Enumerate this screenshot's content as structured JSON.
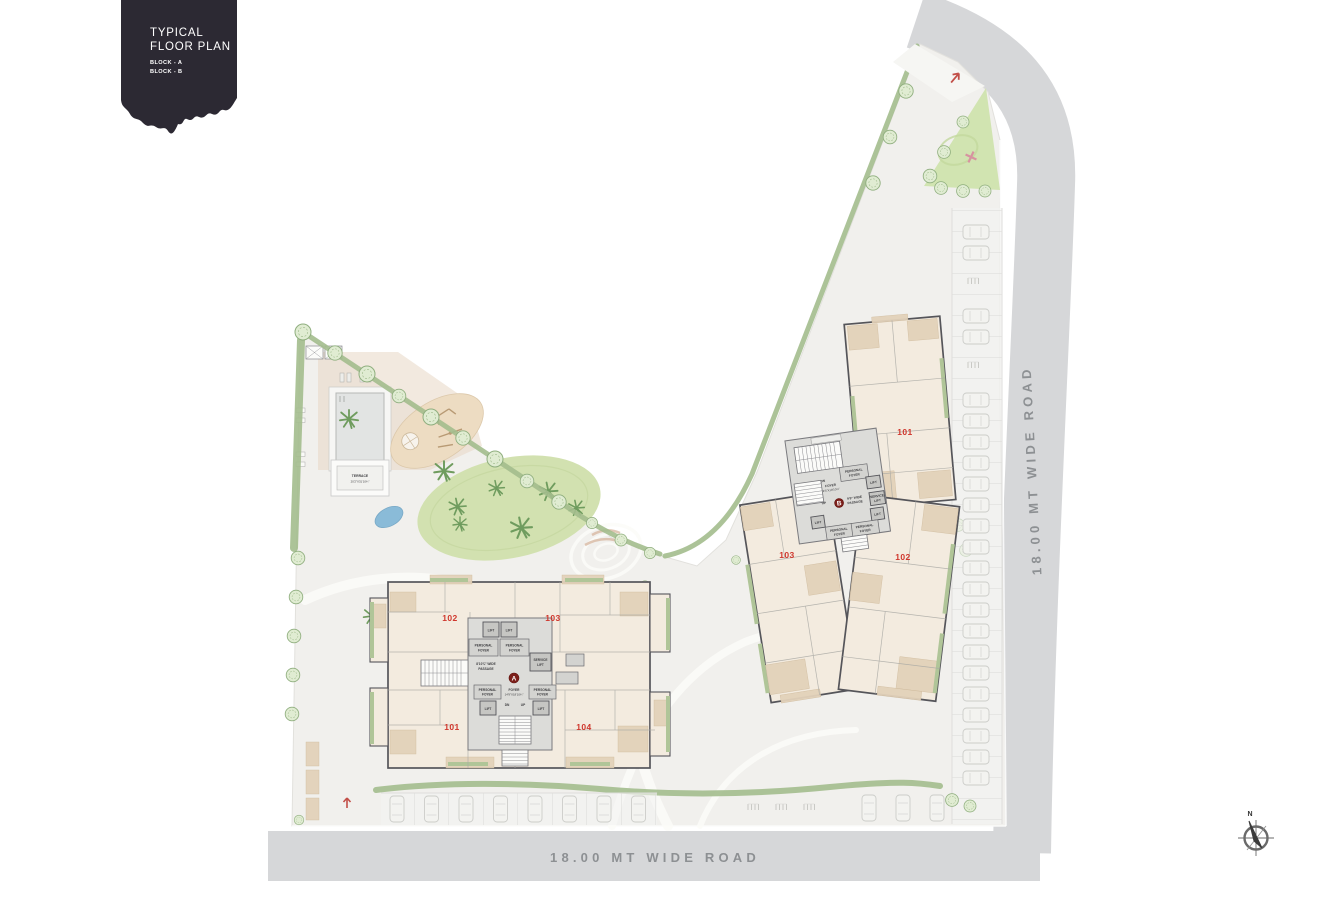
{
  "title_block": {
    "line1": "TYPICAL",
    "line2": "FLOOR PLAN",
    "block_a": "BLOCK - A",
    "block_b": "BLOCK - B"
  },
  "roads": {
    "bottom": "18.00 MT WIDE ROAD",
    "right": "18.00 MT WIDE ROAD"
  },
  "garden": {
    "terrace_name": "TERRACE",
    "terrace_dim": "20'2\"X31'10¾\""
  },
  "labels": {
    "lift": "LIFT",
    "service": "SERVICE",
    "personal": "PERSONAL",
    "foyer": "FOYER",
    "dn": "DN",
    "up": "UP"
  },
  "block_a": {
    "badge": "A",
    "unit_101": "101",
    "unit_102": "102",
    "unit_103": "103",
    "unit_104": "104",
    "passage_line1": "8'10¾\" WIDE",
    "passage_line2": "PASSAGE",
    "foyer_dim": "14'9\"X18'10¾\""
  },
  "block_b": {
    "badge": "B",
    "unit_101": "101",
    "unit_102": "102",
    "unit_103": "103",
    "passage_line1": "9'9\" WIDE",
    "passage_line2": "PASSAGE",
    "foyer_dim": "9'3\"X19'10½\""
  },
  "compass": {
    "north": "N"
  },
  "colors": {
    "road": "#d6d7d9",
    "site_paving": "#f1f0ed",
    "building_fill": "#f3ebdf",
    "room_tan": "#e3d2ba",
    "wall": "#55555a",
    "balcony_green": "#b0c598",
    "lawn_green": "#d2e1b0",
    "tree_green": "#8fae7e",
    "core_gray": "#dcdcd9",
    "unit_red": "#cf362c",
    "badge_maroon": "#7c1f1a",
    "title_bg": "#2c2933"
  }
}
